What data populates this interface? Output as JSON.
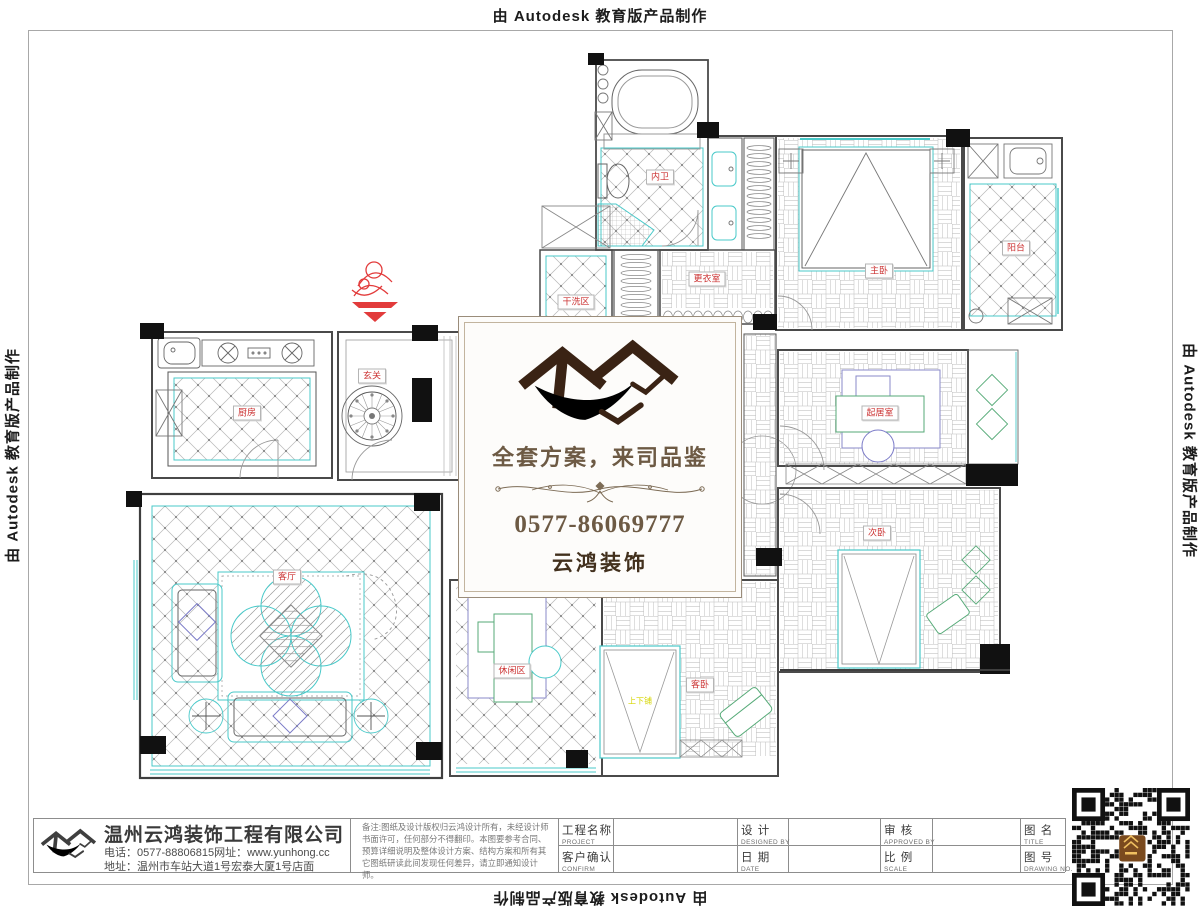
{
  "banners": {
    "top": "由 Autodesk 教育版产品制作",
    "left": "由 Autodesk 教育版产品制作",
    "right": "由 Autodesk 教育版产品制作",
    "bottom": "由 Autodesk 教育版产品制作"
  },
  "watermark": {
    "slogan": "全套方案，来司品鉴",
    "phone": "0577-86069777",
    "brand": "云鸿装饰"
  },
  "plan": {
    "rooms": [
      {
        "label": "内卫"
      },
      {
        "label": "干洗区"
      },
      {
        "label": "更衣室"
      },
      {
        "label": "主卧"
      },
      {
        "label": "阳台"
      },
      {
        "label": "厨房"
      },
      {
        "label": "玄关"
      },
      {
        "label": "客厅"
      },
      {
        "label": "休闲区"
      },
      {
        "label": "客卧"
      },
      {
        "label": "起居室"
      },
      {
        "label": "次卧"
      }
    ],
    "annotations": [
      {
        "label": "上下铺"
      }
    ]
  },
  "title_block": {
    "company": {
      "name": "温州云鸿装饰工程有限公司",
      "phone_line": "电话：0577-88806815网址：www.yunhong.cc",
      "address_line": "地址：温州市车站大道1号宏泰大厦1号店面"
    },
    "notes": "备注:图纸及设计版权归云鸿设计所有，未经设计师书面许可，任何部分不得翻印。本图要参考合同、预算详细说明及整体设计方案、结构方案和所有其它图纸研读此间发现任何差异，请立即通知设计师。",
    "fields": [
      {
        "cn": "工程名称",
        "en": "PROJECT"
      },
      {
        "cn": "设  计",
        "en": "DESIGNED BY"
      },
      {
        "cn": "审  核",
        "en": "APPROVED BY"
      },
      {
        "cn": "图  名",
        "en": "TITLE"
      },
      {
        "cn": "客户确认",
        "en": "CONFIRM"
      },
      {
        "cn": "日  期",
        "en": "DATE"
      },
      {
        "cn": "比  例",
        "en": "SCALE"
      },
      {
        "cn": "图  号",
        "en": "DRAWING NO."
      }
    ]
  },
  "colors": {
    "accent_cyan": "#49c9c9",
    "label_red": "#cc3333",
    "brand_brown": "#3a2314",
    "swoosh_orange": "#f2a318",
    "qr_center_brown": "#7a4a1e"
  }
}
